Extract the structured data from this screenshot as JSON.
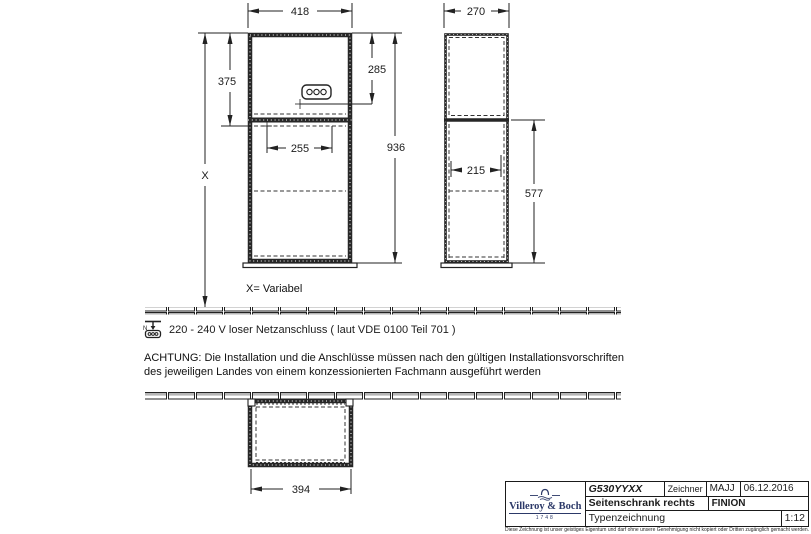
{
  "dims": {
    "front_width": "418",
    "front_upper_left_height": "375",
    "front_socket_height": "285",
    "front_total_height": "936",
    "front_inner_width": "255",
    "front_variable": "X",
    "side_width": "270",
    "side_inner_width": "215",
    "side_lower_height": "577",
    "plan_width": "394"
  },
  "notes": {
    "variable": "X= Variabel",
    "power": "220 - 240 V loser Netzanschluss ( laut VDE 0100 Teil 701 )",
    "warning_line1": "ACHTUNG: Die Installation und die Anschlüsse müssen nach den gültigen Installationsvorschriften",
    "warning_line2": "des jeweiligen Landes von einem konzessionierten Fachmann ausgeführt werden"
  },
  "title_block": {
    "brand": "Villeroy & Boch",
    "brand_year": "1748",
    "part_number": "G530YYXX",
    "drawer_label": "Zeichner",
    "drawer": "MAJJ",
    "date": "06.12.2016",
    "title": "Seitenschrank rechts",
    "series": "FINION",
    "doc_type": "Typenzeichnung",
    "scale": "1:12",
    "copyright": "Diese Zeichnung ist unser geistiges Eigentum und darf ohne unsere Genehmigung nicht kopiert oder Dritten zugänglich gemacht werden."
  },
  "colors": {
    "line": "#262626",
    "logo_navy": "#2c3968",
    "tile_fill": "#b5b5b5"
  }
}
